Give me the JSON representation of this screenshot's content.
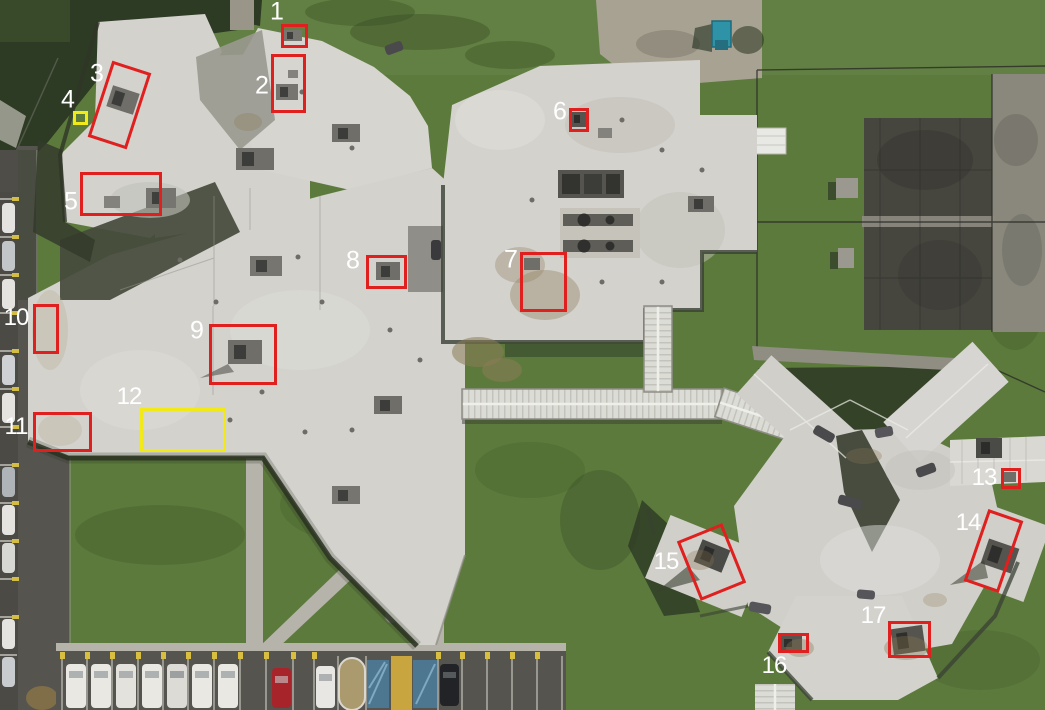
{
  "image": {
    "kind": "aerial-orthophoto",
    "width": 1045,
    "height": 710,
    "subject": "campus with white flat roofs, covered walkways, fenced recreation yard and parking lots, with numbered inspection markers"
  },
  "colors": {
    "red": "#e01f1f",
    "yellow": "#f2ea18",
    "label": "#ffffff"
  },
  "annotations": [
    {
      "id": "1",
      "color": "red",
      "cx": 294,
      "cy": 36,
      "w": 27,
      "h": 24,
      "rot": 0,
      "label": {
        "text": "1",
        "x": 277,
        "y": 12
      }
    },
    {
      "id": "2",
      "color": "red",
      "cx": 288,
      "cy": 83,
      "w": 35,
      "h": 59,
      "rot": 0,
      "label": {
        "text": "2",
        "x": 262,
        "y": 86
      }
    },
    {
      "id": "3",
      "color": "red",
      "cx": 119,
      "cy": 105,
      "w": 41,
      "h": 80,
      "rot": 18,
      "label": {
        "text": "3",
        "x": 97,
        "y": 74
      }
    },
    {
      "id": "4",
      "color": "yellow",
      "cx": 80,
      "cy": 118,
      "w": 15,
      "h": 14,
      "rot": 0,
      "label": {
        "text": "4",
        "x": 68,
        "y": 100
      }
    },
    {
      "id": "5",
      "color": "red",
      "cx": 121,
      "cy": 194,
      "w": 82,
      "h": 44,
      "rot": 0,
      "label": {
        "text": "5",
        "x": 71,
        "y": 202
      }
    },
    {
      "id": "6",
      "color": "red",
      "cx": 579,
      "cy": 120,
      "w": 20,
      "h": 24,
      "rot": 0,
      "label": {
        "text": "6",
        "x": 560,
        "y": 112
      }
    },
    {
      "id": "7",
      "color": "red",
      "cx": 543,
      "cy": 282,
      "w": 47,
      "h": 60,
      "rot": 0,
      "label": {
        "text": "7",
        "x": 511,
        "y": 260
      }
    },
    {
      "id": "8",
      "color": "red",
      "cx": 386,
      "cy": 272,
      "w": 41,
      "h": 34,
      "rot": 0,
      "label": {
        "text": "8",
        "x": 353,
        "y": 261
      }
    },
    {
      "id": "9",
      "color": "red",
      "cx": 243,
      "cy": 354,
      "w": 68,
      "h": 61,
      "rot": 0,
      "label": {
        "text": "9",
        "x": 197,
        "y": 331
      }
    },
    {
      "id": "10",
      "color": "red",
      "cx": 46,
      "cy": 329,
      "w": 26,
      "h": 50,
      "rot": 0,
      "label": {
        "text": "10",
        "x": 16,
        "y": 318
      }
    },
    {
      "id": "11",
      "color": "red",
      "cx": 62,
      "cy": 432,
      "w": 59,
      "h": 40,
      "rot": 0,
      "label": {
        "text": "11",
        "x": 16,
        "y": 427
      }
    },
    {
      "id": "12",
      "color": "yellow",
      "cx": 183,
      "cy": 430,
      "w": 86,
      "h": 44,
      "rot": 0,
      "label": {
        "text": "12",
        "x": 129,
        "y": 397
      }
    },
    {
      "id": "13",
      "color": "red",
      "cx": 1011,
      "cy": 478,
      "w": 20,
      "h": 21,
      "rot": 0,
      "label": {
        "text": "13",
        "x": 984,
        "y": 478
      }
    },
    {
      "id": "14",
      "color": "red",
      "cx": 993,
      "cy": 551,
      "w": 37,
      "h": 76,
      "rot": 19,
      "label": {
        "text": "14",
        "x": 968,
        "y": 523
      }
    },
    {
      "id": "15",
      "color": "red",
      "cx": 711,
      "cy": 562,
      "w": 49,
      "h": 64,
      "rot": -22,
      "label": {
        "text": "15",
        "x": 666,
        "y": 562
      }
    },
    {
      "id": "16",
      "color": "red",
      "cx": 793,
      "cy": 643,
      "w": 31,
      "h": 20,
      "rot": 0,
      "label": {
        "text": "16",
        "x": 774,
        "y": 666
      }
    },
    {
      "id": "17",
      "color": "red",
      "cx": 909,
      "cy": 639,
      "w": 43,
      "h": 37,
      "rot": 0,
      "label": {
        "text": "17",
        "x": 873,
        "y": 616
      }
    }
  ]
}
